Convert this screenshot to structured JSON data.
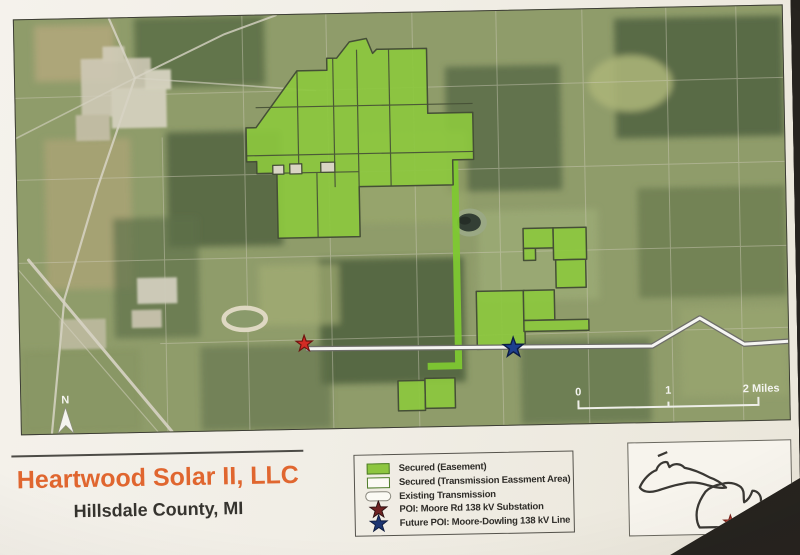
{
  "page": {
    "title": "Heartwood Solar II, LLC",
    "subtitle": "Hillsdale County, MI"
  },
  "map": {
    "north_label": "N",
    "scale": {
      "labels": [
        "0",
        "1",
        "2 Miles"
      ]
    },
    "markers": {
      "substation": "red-star",
      "future_poi": "blue-star"
    }
  },
  "legend": {
    "items": [
      {
        "label": "Secured (Easement)",
        "swatch": "filled-green-rect"
      },
      {
        "label": "Secured (Transmission Eassment Area)",
        "swatch": "green-outline-rect"
      },
      {
        "label": "Existing Transmission",
        "swatch": "white-capsule"
      },
      {
        "label": "POI: Moore Rd 138 kV Substation",
        "swatch": "dark-red-star"
      },
      {
        "label": "Future POI: Moore-Dowling 138 kV Line",
        "swatch": "navy-star"
      }
    ]
  },
  "inset": {
    "region": "Michigan",
    "marker": "red-star"
  },
  "colors": {
    "title": "#e0662f",
    "secured_fill": "#8dc63f",
    "secured_outline": "#4e7b28",
    "corridor_green": "#7ec832",
    "legend_substation_star": "#6e2222",
    "legend_future_star": "#1c3572",
    "map_substation_star": "#d32b24",
    "map_future_star": "#1d3f8f",
    "transmission_line": "#f5f5f2",
    "inset_marker": "#c43b2e"
  }
}
